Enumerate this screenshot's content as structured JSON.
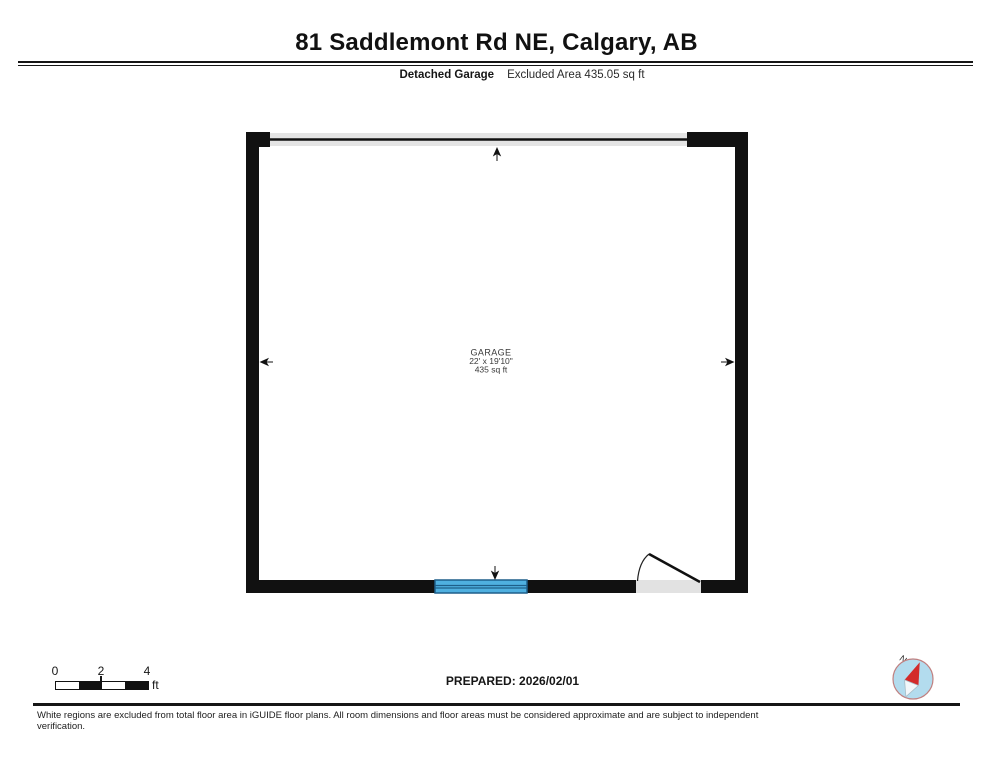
{
  "header": {
    "title": "81 Saddlemont Rd NE, Calgary, AB",
    "floor_label": "Detached Garage",
    "area_label": "Excluded Area 435.05 sq ft"
  },
  "plan": {
    "room": {
      "name": "GARAGE",
      "dimensions": "22' x 19'10\"",
      "area": "435 sq ft"
    }
  },
  "footer": {
    "scale_bar": {
      "tick_labels": [
        "0",
        "2",
        "4"
      ],
      "unit": "ft"
    },
    "prepared": "PREPARED: 2026/02/01",
    "compass": {
      "north_label": "N"
    },
    "disclaimer": "White regions are excluded from total floor area in iGUIDE floor plans. All room dimensions and floor areas must be considered approximate and are subject to independent verification."
  },
  "colors": {
    "wall": "#111111",
    "garage_door_fill": "#e4e4e4",
    "door_opening_fill": "#e2e2e2",
    "window_fill": "#4fb0e0",
    "window_frame": "#1e5f8a",
    "compass_fill": "#b3dcee",
    "compass_ring": "#c08080",
    "needle_red": "#d32b2b",
    "needle_tail": "#f2f7fa"
  }
}
